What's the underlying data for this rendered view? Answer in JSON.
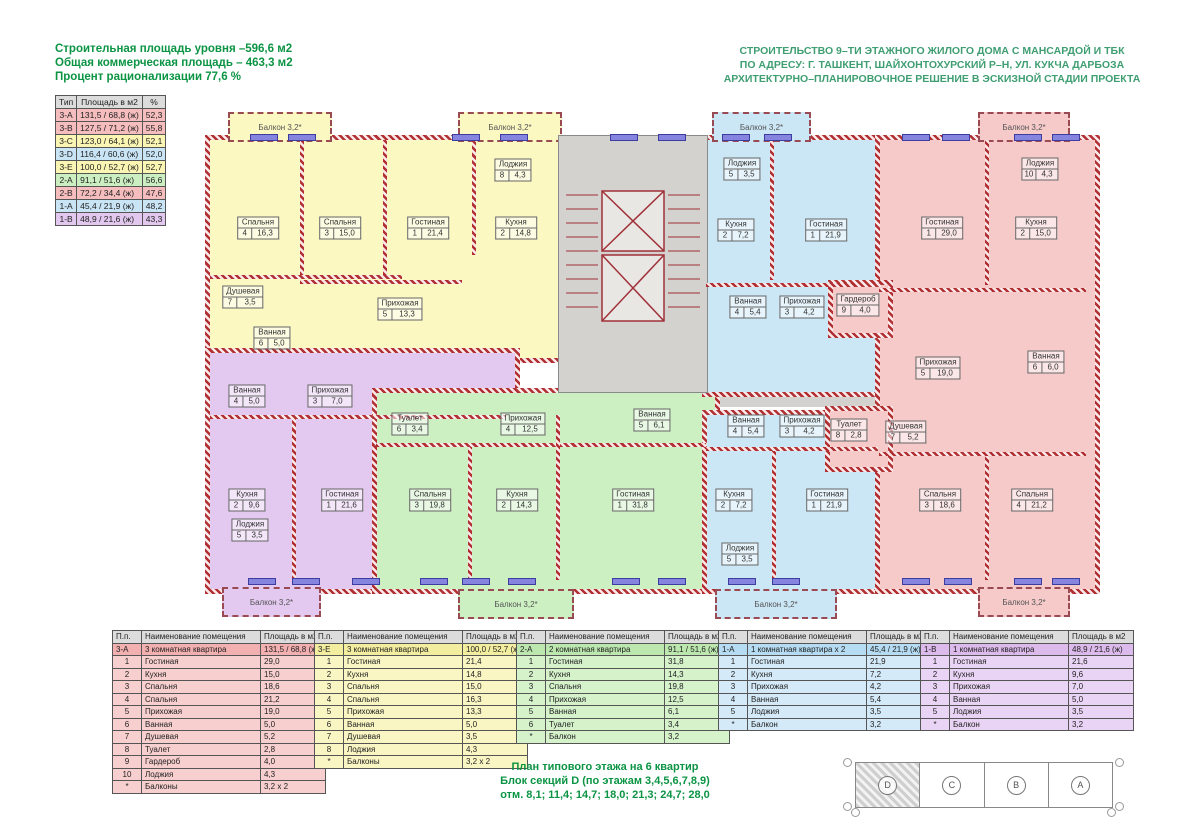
{
  "palette": {
    "yellow": "#fbf8c2",
    "blue": "#cbe6f5",
    "pink": "#f7caca",
    "green": "#cdf0c3",
    "purple": "#e3c8ef",
    "gray": "#d4d2ce",
    "wall": "#b03034",
    "green_text": "#0b9444",
    "balcony_yellow": "#fbf8c2",
    "balcony_blue": "#cbe6f5",
    "balcony_pink": "#f7caca",
    "balcony_green": "#cdf0c3",
    "balcony_purple": "#e3c8ef"
  },
  "header": {
    "left_lines": [
      "Строительная площадь уровня –596,6 м2",
      "Общая коммерческая площадь – 463,3 м2",
      "Процент рационализации 77,6 %"
    ],
    "right_lines": [
      "СТРОИТЕЛЬСТВО 9–ТИ ЭТАЖНОГО ЖИЛОГО ДОМА С МАНСАРДОЙ И ТБК",
      "ПО АДРЕСУ: Г. ТАШКЕНТ, ШАЙХОНТОХУРСКИЙ Р–Н, УЛ. КУКЧА ДАРБОЗА",
      "АРХИТЕКТУРНО–ПЛАНИРОВОЧНОЕ РЕШЕНИЕ В ЭСКИЗНОЙ СТАДИИ ПРОЕКТА"
    ]
  },
  "summary_table": {
    "headers": [
      "Тип",
      "Площадь в м2",
      "%"
    ],
    "rows": [
      {
        "type": "3-A",
        "area": "131,5 / 68,8 (ж)",
        "pct": "52,3",
        "color": "#f5bdbd"
      },
      {
        "type": "3-B",
        "area": "127,5 / 71,2 (ж)",
        "pct": "55,8",
        "color": "#f5bdbd"
      },
      {
        "type": "3-C",
        "area": "123,0 / 64,1 (ж)",
        "pct": "52,1",
        "color": "#faf5b2"
      },
      {
        "type": "3-D",
        "area": "116,4 / 60,6 (ж)",
        "pct": "52,0",
        "color": "#c9e4f5"
      },
      {
        "type": "3-E",
        "area": "100,0 / 52,7 (ж)",
        "pct": "52,7",
        "color": "#faf5b2"
      },
      {
        "type": "2-A",
        "area": "91,1 / 51,6 (ж)",
        "pct": "56,6",
        "color": "#cbefc1"
      },
      {
        "type": "2-B",
        "area": "72,2 / 34,4 (ж)",
        "pct": "47,6",
        "color": "#f5bdbd"
      },
      {
        "type": "1-A",
        "area": "45,4 / 21,9 (ж)",
        "pct": "48,2",
        "color": "#c9e4f5"
      },
      {
        "type": "1-B",
        "area": "48,9 / 21,6 (ж)",
        "pct": "43,3",
        "color": "#e2c7ee"
      }
    ]
  },
  "plan": {
    "apartments": [
      {
        "id": "3-E",
        "fill": "yellow",
        "rooms": [
          {
            "name": "Спальня",
            "num": "4",
            "area": "16,3",
            "x": 258,
            "y": 228
          },
          {
            "name": "Спальня",
            "num": "3",
            "area": "15,0",
            "x": 340,
            "y": 228
          },
          {
            "name": "Гостиная",
            "num": "1",
            "area": "21,4",
            "x": 428,
            "y": 228
          },
          {
            "name": "Кухня",
            "num": "2",
            "area": "14,8",
            "x": 516,
            "y": 228
          },
          {
            "name": "Лоджия",
            "num": "8",
            "area": "4,3",
            "x": 513,
            "y": 170
          },
          {
            "name": "Душевая",
            "num": "7",
            "area": "3,5",
            "x": 243,
            "y": 297
          },
          {
            "name": "Прихожая",
            "num": "5",
            "area": "13,3",
            "x": 400,
            "y": 309
          },
          {
            "name": "Ванная",
            "num": "6",
            "area": "5,0",
            "x": 272,
            "y": 338
          }
        ]
      },
      {
        "id": "1-B",
        "fill": "purple",
        "rooms": [
          {
            "name": "Ванная",
            "num": "4",
            "area": "5,0",
            "x": 247,
            "y": 396
          },
          {
            "name": "Прихожая",
            "num": "3",
            "area": "7,0",
            "x": 330,
            "y": 396
          },
          {
            "name": "Кухня",
            "num": "2",
            "area": "9,6",
            "x": 247,
            "y": 500
          },
          {
            "name": "Гостиная",
            "num": "1",
            "area": "21,6",
            "x": 342,
            "y": 500
          },
          {
            "name": "Лоджия",
            "num": "5",
            "area": "3,5",
            "x": 250,
            "y": 530
          }
        ]
      },
      {
        "id": "2-A",
        "fill": "green",
        "rooms": [
          {
            "name": "Туалет",
            "num": "6",
            "area": "3,4",
            "x": 410,
            "y": 424
          },
          {
            "name": "Прихожая",
            "num": "4",
            "area": "12,5",
            "x": 523,
            "y": 424
          },
          {
            "name": "Ванная",
            "num": "5",
            "area": "6,1",
            "x": 652,
            "y": 420
          },
          {
            "name": "Спальня",
            "num": "3",
            "area": "19,8",
            "x": 430,
            "y": 500
          },
          {
            "name": "Кухня",
            "num": "2",
            "area": "14,3",
            "x": 517,
            "y": 500
          },
          {
            "name": "Гостиная",
            "num": "1",
            "area": "31,8",
            "x": 633,
            "y": 500
          }
        ]
      },
      {
        "id": "1-A",
        "fill": "blue",
        "rooms": [
          {
            "name": "Лоджия",
            "num": "5",
            "area": "3,5",
            "x": 742,
            "y": 169
          },
          {
            "name": "Кухня",
            "num": "2",
            "area": "7,2",
            "x": 736,
            "y": 230
          },
          {
            "name": "Гостиная",
            "num": "1",
            "area": "21,9",
            "x": 826,
            "y": 230
          },
          {
            "name": "Ванная",
            "num": "4",
            "area": "5,4",
            "x": 748,
            "y": 307
          },
          {
            "name": "Прихожая",
            "num": "3",
            "area": "4,2",
            "x": 802,
            "y": 307
          }
        ]
      },
      {
        "id": "1-A-2",
        "fill": "blue",
        "rooms": [
          {
            "name": "Ванная",
            "num": "4",
            "area": "5,4",
            "x": 746,
            "y": 426
          },
          {
            "name": "Прихожая",
            "num": "3",
            "area": "4,2",
            "x": 802,
            "y": 426
          },
          {
            "name": "Кухня",
            "num": "2",
            "area": "7,2",
            "x": 734,
            "y": 500
          },
          {
            "name": "Гостиная",
            "num": "1",
            "area": "21,9",
            "x": 827,
            "y": 500
          },
          {
            "name": "Лоджия",
            "num": "5",
            "area": "3,5",
            "x": 740,
            "y": 554
          }
        ]
      },
      {
        "id": "3-A",
        "fill": "pink",
        "rooms": [
          {
            "name": "Гостиная",
            "num": "1",
            "area": "29,0",
            "x": 942,
            "y": 228
          },
          {
            "name": "Кухня",
            "num": "2",
            "area": "15,0",
            "x": 1036,
            "y": 228
          },
          {
            "name": "Лоджия",
            "num": "10",
            "area": "4,3",
            "x": 1040,
            "y": 169
          },
          {
            "name": "Гардероб",
            "num": "9",
            "area": "4,0",
            "x": 858,
            "y": 305
          },
          {
            "name": "Прихожая",
            "num": "5",
            "area": "19,0",
            "x": 938,
            "y": 368
          },
          {
            "name": "Ванная",
            "num": "6",
            "area": "6,0",
            "x": 1046,
            "y": 362
          },
          {
            "name": "Туалет",
            "num": "8",
            "area": "2,8",
            "x": 849,
            "y": 430
          },
          {
            "name": "Душевая",
            "num": "7",
            "area": "5,2",
            "x": 906,
            "y": 432
          },
          {
            "name": "Спальня",
            "num": "3",
            "area": "18,6",
            "x": 940,
            "y": 500
          },
          {
            "name": "Спальня",
            "num": "4",
            "area": "21,2",
            "x": 1032,
            "y": 500
          }
        ]
      }
    ],
    "balconies": [
      {
        "label": "Балкон 3,2*",
        "x": 228,
        "y": 112,
        "w": 100,
        "h": 26,
        "fill": "balcony_yellow"
      },
      {
        "label": "Балкон 3,2*",
        "x": 458,
        "y": 112,
        "w": 100,
        "h": 26,
        "fill": "balcony_yellow"
      },
      {
        "label": "Балкон 3,2*",
        "x": 712,
        "y": 112,
        "w": 95,
        "h": 26,
        "fill": "balcony_blue"
      },
      {
        "label": "Балкон 3,2*",
        "x": 978,
        "y": 112,
        "w": 88,
        "h": 26,
        "fill": "balcony_pink"
      },
      {
        "label": "Балкон 3,2*",
        "x": 222,
        "y": 587,
        "w": 95,
        "h": 26,
        "fill": "balcony_purple"
      },
      {
        "label": "Балкон 3,2*",
        "x": 458,
        "y": 589,
        "w": 112,
        "h": 26,
        "fill": "balcony_green"
      },
      {
        "label": "Балкон 3,2*",
        "x": 715,
        "y": 589,
        "w": 118,
        "h": 26,
        "fill": "balcony_blue"
      },
      {
        "label": "Балкон 3,2*",
        "x": 978,
        "y": 587,
        "w": 88,
        "h": 26,
        "fill": "balcony_pink"
      }
    ]
  },
  "room_tables": [
    {
      "x": 112,
      "title_color": "#f3b0b0",
      "row_color": "#f8cfcf",
      "headers": [
        "П.п.",
        "Наименование помещения",
        "Площадь в м2"
      ],
      "title": {
        "no": "3-А",
        "name": "3 комнатная квартира",
        "area": "131,5 / 68,8 (ж)"
      },
      "rows": [
        [
          "1",
          "Гостиная",
          "29,0"
        ],
        [
          "2",
          "Кухня",
          "15,0"
        ],
        [
          "3",
          "Спальня",
          "18,6"
        ],
        [
          "4",
          "Спальня",
          "21,2"
        ],
        [
          "5",
          "Прихожая",
          "19,0"
        ],
        [
          "6",
          "Ванная",
          "5,0"
        ],
        [
          "7",
          "Душевая",
          "5,2"
        ],
        [
          "8",
          "Туалет",
          "2,8"
        ],
        [
          "9",
          "Гардероб",
          "4,0"
        ],
        [
          "10",
          "Лоджия",
          "4,3"
        ],
        [
          "*",
          "Балконы",
          "3,2 х 2"
        ]
      ]
    },
    {
      "x": 314,
      "title_color": "#f3eda0",
      "row_color": "#faf6c3",
      "headers": [
        "П.п.",
        "Наименование помещения",
        "Площадь в м2"
      ],
      "title": {
        "no": "3-Е",
        "name": "3 комнатная квартира",
        "area": "100,0 / 52,7 (ж)"
      },
      "rows": [
        [
          "1",
          "Гостиная",
          "21,4"
        ],
        [
          "2",
          "Кухня",
          "14,8"
        ],
        [
          "3",
          "Спальня",
          "15,0"
        ],
        [
          "4",
          "Спальня",
          "16,3"
        ],
        [
          "5",
          "Прихожая",
          "13,3"
        ],
        [
          "6",
          "Ванная",
          "5,0"
        ],
        [
          "7",
          "Душевая",
          "3,5"
        ],
        [
          "8",
          "Лоджия",
          "4,3"
        ],
        [
          "*",
          "Балконы",
          "3,2 х 2"
        ]
      ]
    },
    {
      "x": 516,
      "title_color": "#bce8af",
      "row_color": "#d5f2cb",
      "headers": [
        "П.п.",
        "Наименование помещения",
        "Площадь в м2"
      ],
      "title": {
        "no": "2-А",
        "name": "2 комнатная квартира",
        "area": "91,1 / 51,6 (ж)"
      },
      "rows": [
        [
          "1",
          "Гостиная",
          "31,8"
        ],
        [
          "2",
          "Кухня",
          "14,3"
        ],
        [
          "3",
          "Спальня",
          "19,8"
        ],
        [
          "4",
          "Прихожая",
          "12,5"
        ],
        [
          "5",
          "Ванная",
          "6,1"
        ],
        [
          "6",
          "Туалет",
          "3,4"
        ],
        [
          "*",
          "Балкон",
          "3,2"
        ]
      ]
    },
    {
      "x": 718,
      "title_color": "#b5dcf2",
      "row_color": "#d4eaf8",
      "headers": [
        "П.п.",
        "Наименование помещения",
        "Площадь в м2"
      ],
      "title": {
        "no": "1-А",
        "name": "1 комнатная квартира х 2",
        "area": "45,4 / 21,9 (ж)"
      },
      "rows": [
        [
          "1",
          "Гостиная",
          "21,9"
        ],
        [
          "2",
          "Кухня",
          "7,2"
        ],
        [
          "3",
          "Прихожая",
          "4,2"
        ],
        [
          "4",
          "Ванная",
          "5,4"
        ],
        [
          "5",
          "Лоджия",
          "3,5"
        ],
        [
          "*",
          "Балкон",
          "3,2"
        ]
      ]
    },
    {
      "x": 920,
      "title_color": "#dcbaeb",
      "row_color": "#ead4f5",
      "headers": [
        "П.п.",
        "Наименование помещения",
        "Площадь в м2"
      ],
      "title": {
        "no": "1-В",
        "name": "1 комнатная квартира",
        "area": "48,9 / 21,6 (ж)"
      },
      "rows": [
        [
          "1",
          "Гостиная",
          "21,6"
        ],
        [
          "2",
          "Кухня",
          "9,6"
        ],
        [
          "3",
          "Прихожая",
          "7,0"
        ],
        [
          "4",
          "Ванная",
          "5,0"
        ],
        [
          "5",
          "Лоджия",
          "3,5"
        ],
        [
          "*",
          "Балкон",
          "3,2"
        ]
      ]
    }
  ],
  "footer": {
    "lines": [
      "План типового этажа на 6 квартир",
      "Блок секций D (по этажам 3,4,5,6,7,8,9)",
      "отм. 8,1;  11,4;  14,7;  18,0;  21,3;  24,7;  28,0"
    ]
  },
  "keyplan": {
    "sections": [
      {
        "label": "D",
        "hatched": true
      },
      {
        "label": "C",
        "hatched": false
      },
      {
        "label": "B",
        "hatched": false
      },
      {
        "label": "A",
        "hatched": false
      }
    ]
  }
}
